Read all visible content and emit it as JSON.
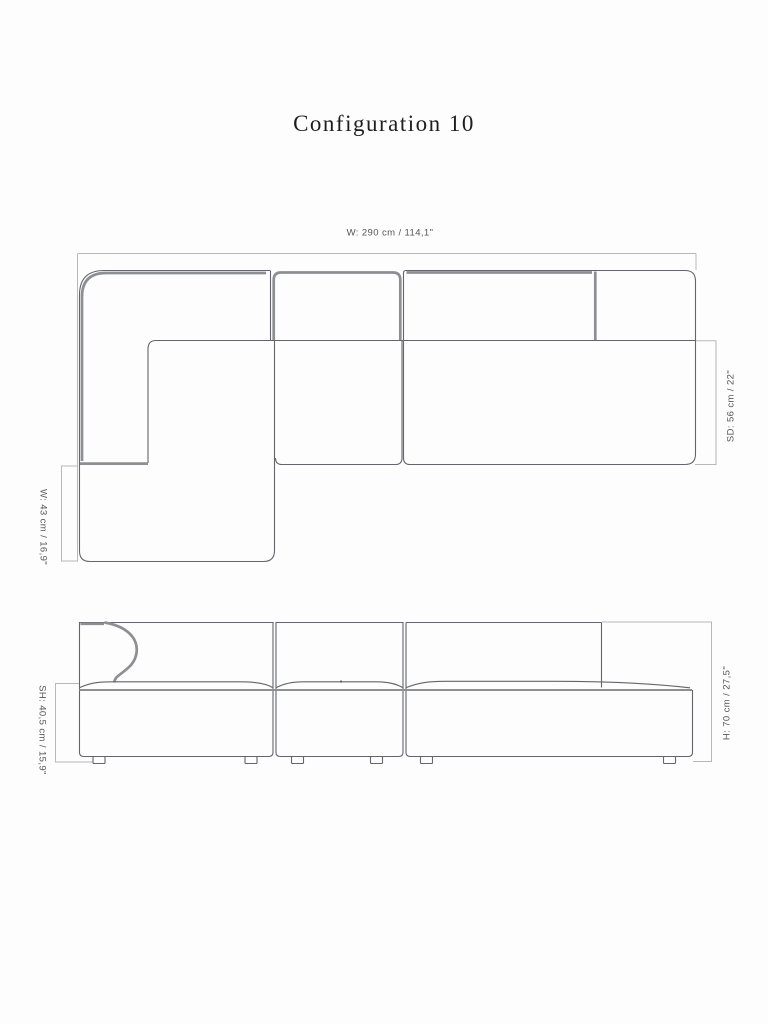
{
  "page": {
    "title": "Configuration 10"
  },
  "dimensions": {
    "top_width": "W: 290 cm / 114,1\"",
    "seat_depth": "SD: 56 cm / 22\"",
    "chaise_extension": "W: 43 cm / 16,9\"",
    "seat_height": "SH: 40,5 cm / 15,9\"",
    "total_height": "H: 70 cm / 27,5\""
  },
  "colors": {
    "bg": "#fdfdfd",
    "outline": "#63656a",
    "piping": "#8d8f92",
    "dim": "#b7b8ba",
    "label": "#55565a",
    "title": "#1e1e1f"
  }
}
